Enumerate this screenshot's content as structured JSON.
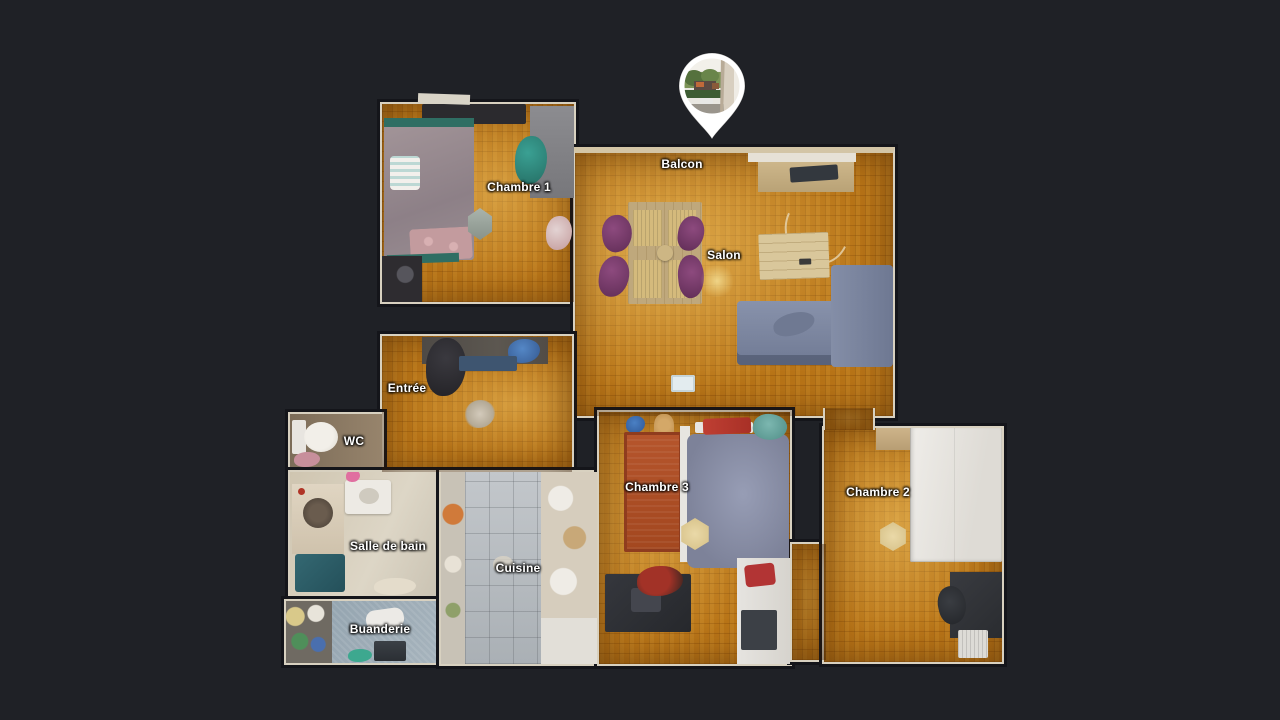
{
  "app": {
    "view_name": "dollhouse-floor-plan",
    "background_color": "#1f2126",
    "label_text_color": "#ffffff"
  },
  "rooms": [
    {
      "id": "chambre-1",
      "label": "Chambre 1"
    },
    {
      "id": "balcon",
      "label": "Balcon"
    },
    {
      "id": "salon",
      "label": "Salon"
    },
    {
      "id": "entree",
      "label": "Entrée"
    },
    {
      "id": "wc",
      "label": "WC"
    },
    {
      "id": "chambre-3",
      "label": "Chambre 3"
    },
    {
      "id": "chambre-2",
      "label": "Chambre 2"
    },
    {
      "id": "salle-de-bain",
      "label": "Salle de bain"
    },
    {
      "id": "cuisine",
      "label": "Cuisine"
    },
    {
      "id": "buanderie",
      "label": "Buanderie"
    }
  ],
  "pin": {
    "icon": "location-pin-icon",
    "color": "#ffffff",
    "thumbnail": "exterior balcony panorama with green hedges, trees and building",
    "points_to": "Balcon"
  },
  "colors": {
    "parquet": "#b87417",
    "kitchen_tile": "#b7bcc0",
    "sofa": "#7e88a1",
    "chairs": "#7a3c6e",
    "rug_chambre3": "#b5552c"
  }
}
